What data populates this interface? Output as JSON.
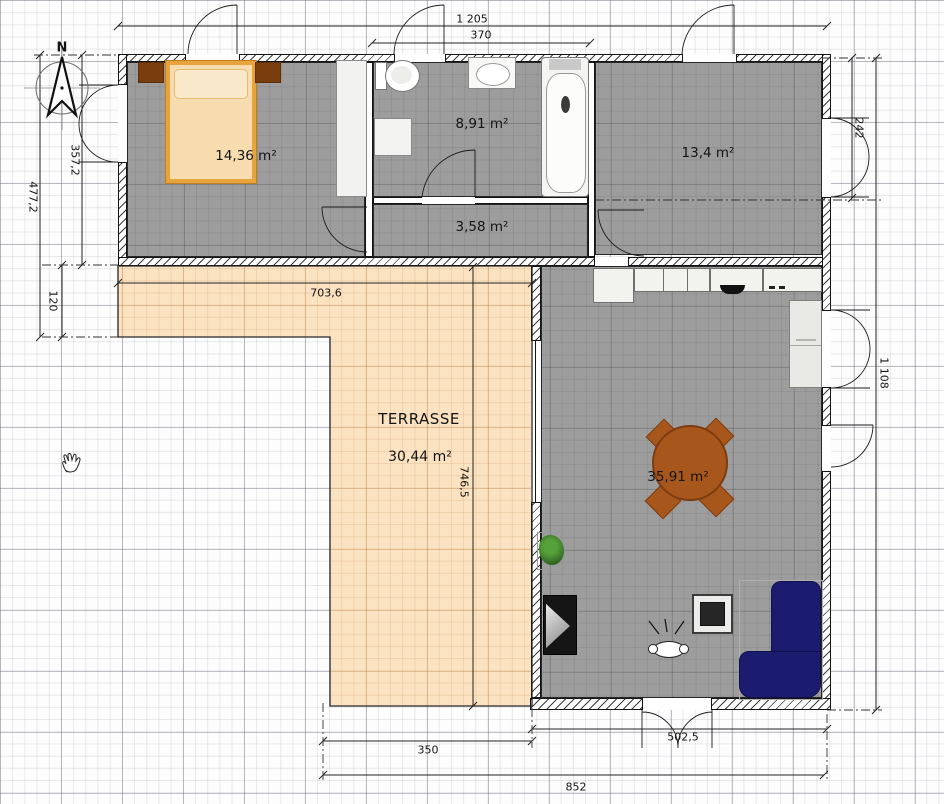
{
  "plan_title": "floor-plan",
  "compass": {
    "label": "N"
  },
  "rooms": {
    "bedroom": {
      "area": "14,36 m²"
    },
    "bathroom": {
      "area": "8,91 m²"
    },
    "hallway": {
      "area": "3,58 m²"
    },
    "office": {
      "area": "13,4 m²"
    },
    "living": {
      "area": "35,91 m²"
    },
    "terrace": {
      "name": "TERRASSE",
      "area": "30,44 m²"
    }
  },
  "dimensions": {
    "top_total": "1 205",
    "bathroom_width": "370",
    "left_total": "477,2",
    "bedroom_height": "357,2",
    "terrace_offset": "120",
    "window_height": "242",
    "right_total": "1 108",
    "terrace_width": "703,6",
    "terrace_height": "746,5",
    "living_width": "502,5",
    "terrace_bottom_width": "350",
    "bottom_total": "852"
  },
  "colors": {
    "room_fill": "#9d9d9d",
    "terrace_fill": "#fbe3c2",
    "sofa": "#1b1b70",
    "dining_set": "#a8571c",
    "bed_frame": "#e8a33c",
    "bed_mattress": "#f6dcae",
    "nightstand": "#7a3d0e"
  }
}
